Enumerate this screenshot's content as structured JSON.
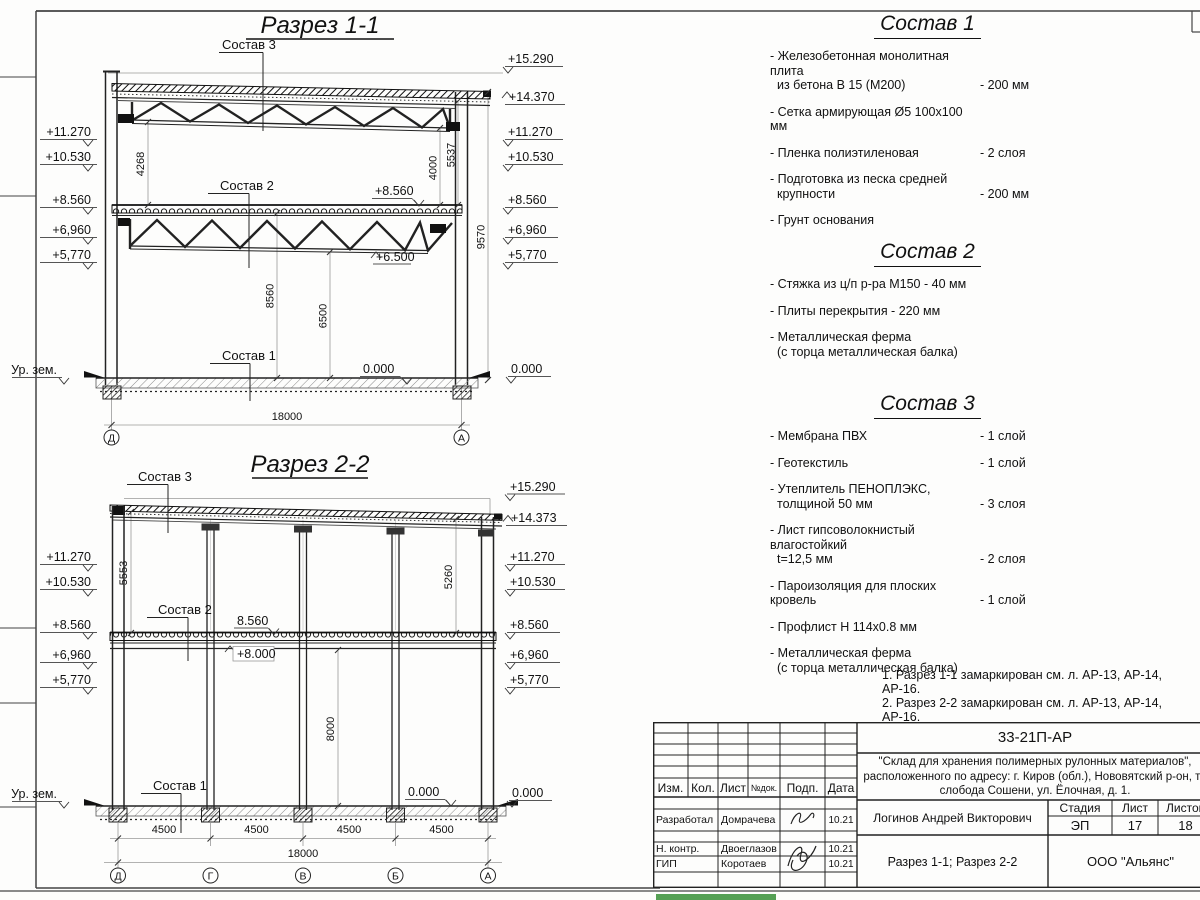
{
  "sheet": {
    "green_bar_color": "#55a055"
  },
  "sections": {
    "s1": {
      "title": "Разрез 1-1",
      "sostav3": "Состав 3",
      "sostav2": "Состав 2",
      "sostav1": "Состав 1",
      "left_elevs": [
        "+11.270",
        "+10.530",
        "+8.560",
        "+6,960",
        "+5,770"
      ],
      "right_elevs": [
        "+15.290",
        "+14.370",
        "+11.270",
        "+10.530",
        "+8.560",
        "+6,960",
        "+5,770",
        "0.000"
      ],
      "ground_label": "Ур. зем.",
      "inner_8560": "+8.560",
      "inner_6500": "+6.500",
      "inner_0000": "0.000",
      "dim_4268": "4268",
      "dim_4000": "4000",
      "dim_5537": "5537",
      "dim_9570": "9570",
      "dim_8560": "8560",
      "dim_6500": "6500",
      "dim_18000": "18000",
      "axes": [
        "Д",
        "А"
      ]
    },
    "s2": {
      "title": "Разрез 2-2",
      "sostav3": "Состав 3",
      "sostav2": "Состав 2",
      "sostav1": "Состав 1",
      "left_elevs": [
        "+11.270",
        "+10.530",
        "+8.560",
        "+6,960",
        "+5,770"
      ],
      "right_elevs": [
        "+15.290",
        "+14.373",
        "+11.270",
        "+10.530",
        "+8.560",
        "+6,960",
        "+5,770",
        "0.000"
      ],
      "ground_label": "Ур. зем.",
      "inner_8560": "8.560",
      "inner_8000": "+8.000",
      "inner_0000": "0.000",
      "dim_5553": "5553",
      "dim_5260": "5260",
      "dim_8000": "8000",
      "dim_spans": [
        "4500",
        "4500",
        "4500",
        "4500"
      ],
      "dim_18000": "18000",
      "axes": [
        "Д",
        "Г",
        "В",
        "Б",
        "А"
      ]
    }
  },
  "compositions": [
    {
      "title": "Состав 1",
      "items": [
        {
          "l1": "- Железобетонная  монолитная плита",
          "l2": "из бетона В 15 (М200)",
          "value": "- 200 мм"
        },
        {
          "l1": "- Сетка армирующая Ø5 100x100 мм",
          "l2": "",
          "value": ""
        },
        {
          "l1": "- Пленка полиэтиленовая",
          "l2": "",
          "value": "- 2 слоя"
        },
        {
          "l1": "- Подготовка из песка средней",
          "l2": "крупности",
          "value": "- 200 мм"
        },
        {
          "l1": "- Грунт основания",
          "l2": "",
          "value": ""
        }
      ]
    },
    {
      "title": "Состав 2",
      "items": [
        {
          "l1": "- Стяжка из ц/п р-ра М150 - 40 мм",
          "l2": "",
          "value": ""
        },
        {
          "l1": "- Плиты перекрытия - 220 мм",
          "l2": "",
          "value": ""
        },
        {
          "l1": "- Металлическая ферма",
          "l2": "(с торца металлическая балка)",
          "value": ""
        }
      ]
    },
    {
      "title": "Состав 3",
      "items": [
        {
          "l1": "- Мембрана ПВХ",
          "l2": "",
          "value": "- 1 слой"
        },
        {
          "l1": "- Геотекстиль",
          "l2": "",
          "value": "- 1 слой"
        },
        {
          "l1": "- Утеплитель ПЕНОПЛЭКС,",
          "l2": "толщиной 50 мм",
          "value": "- 3 слоя"
        },
        {
          "l1": "- Лист гипсоволокнистый влагостойкий",
          "l2": "t=12,5 мм",
          "value": "- 2 слоя"
        },
        {
          "l1": "- Пароизоляция для плоских кровель",
          "l2": "",
          "value": "- 1 слой"
        },
        {
          "l1": "- Профлист Н 114х0.8 мм",
          "l2": "",
          "value": ""
        },
        {
          "l1": "- Металлическая ферма",
          "l2": "(с торца металлическая балка)",
          "value": ""
        }
      ]
    }
  ],
  "notes": [
    "1. Разрез 1-1 замаркирован см. л. АР-13, АР-14, АР-16.",
    "2. Разрез 2-2 замаркирован см. л. АР-13, АР-14, АР-16."
  ],
  "titleblock": {
    "doc_number": "33-21П-АР",
    "project_line1": "\"Склад для хранения полимерных рулонных материалов\",",
    "project_line2": "расположенного по адресу: г. Киров (обл.), Нововятский р-он, те",
    "project_line3": "слобода Сошени, ул. Ёлочная, д. 1.",
    "cols": {
      "izm": "Изм.",
      "kol": "Кол.",
      "list": "Лист",
      "ndok": "№док.",
      "podp": "Подп.",
      "data": "Дата"
    },
    "rows": [
      {
        "role": "Разработал",
        "name": "Домрачева",
        "date": "10.21"
      },
      {
        "role": "Н. контр.",
        "name": "Двоеглазов",
        "date": "10.21"
      },
      {
        "role": "ГИП",
        "name": "Коротаев",
        "date": "10.21"
      }
    ],
    "person": "Логинов Андрей Викторович",
    "stage_label": "Стадия",
    "sheet_label": "Лист",
    "sheets_label": "Листов",
    "stage": "ЭП",
    "sheet_num": "17",
    "sheets_total": "18",
    "drawing_title": "Разрез 1-1; Разрез 2-2",
    "company": "ООО \"Альянс\""
  }
}
